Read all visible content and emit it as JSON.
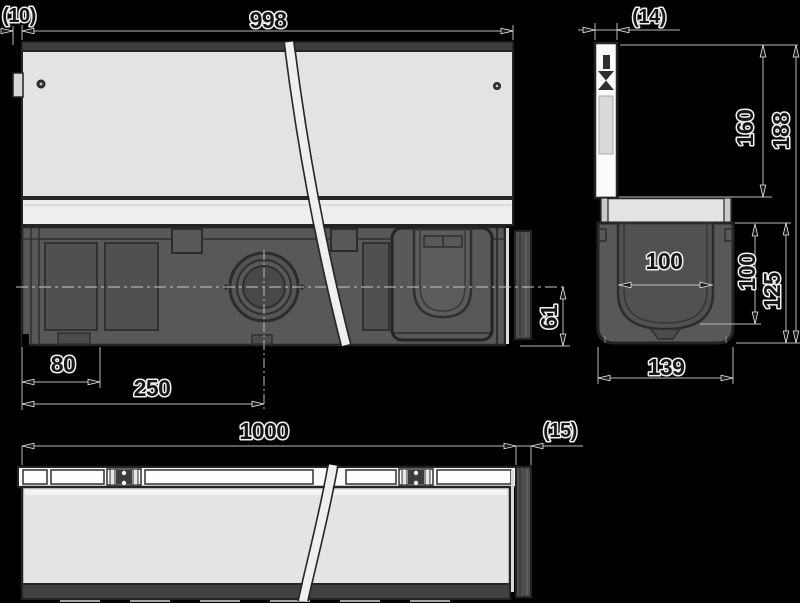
{
  "colors": {
    "background": "#000000",
    "cover_fill": "#e2e4e3",
    "body_fill": "#565859",
    "outline": "#232425",
    "dim_line": "#b9bbbc"
  },
  "views": {
    "front": {
      "dims": {
        "length": "998",
        "left_end": "(10)",
        "outlet_offset_small": "80",
        "outlet_offset_large": "250",
        "outlet_center_height": "61"
      }
    },
    "section": {
      "dims": {
        "edge_thickness": "(14)",
        "height_to_cover_seat": "160",
        "total_height": "188",
        "inner_width": "100",
        "inner_depth": "100",
        "channel_height": "125",
        "outer_width": "139"
      }
    },
    "plan": {
      "dims": {
        "length": "1000",
        "end_cap_thickness": "(15)"
      }
    }
  }
}
